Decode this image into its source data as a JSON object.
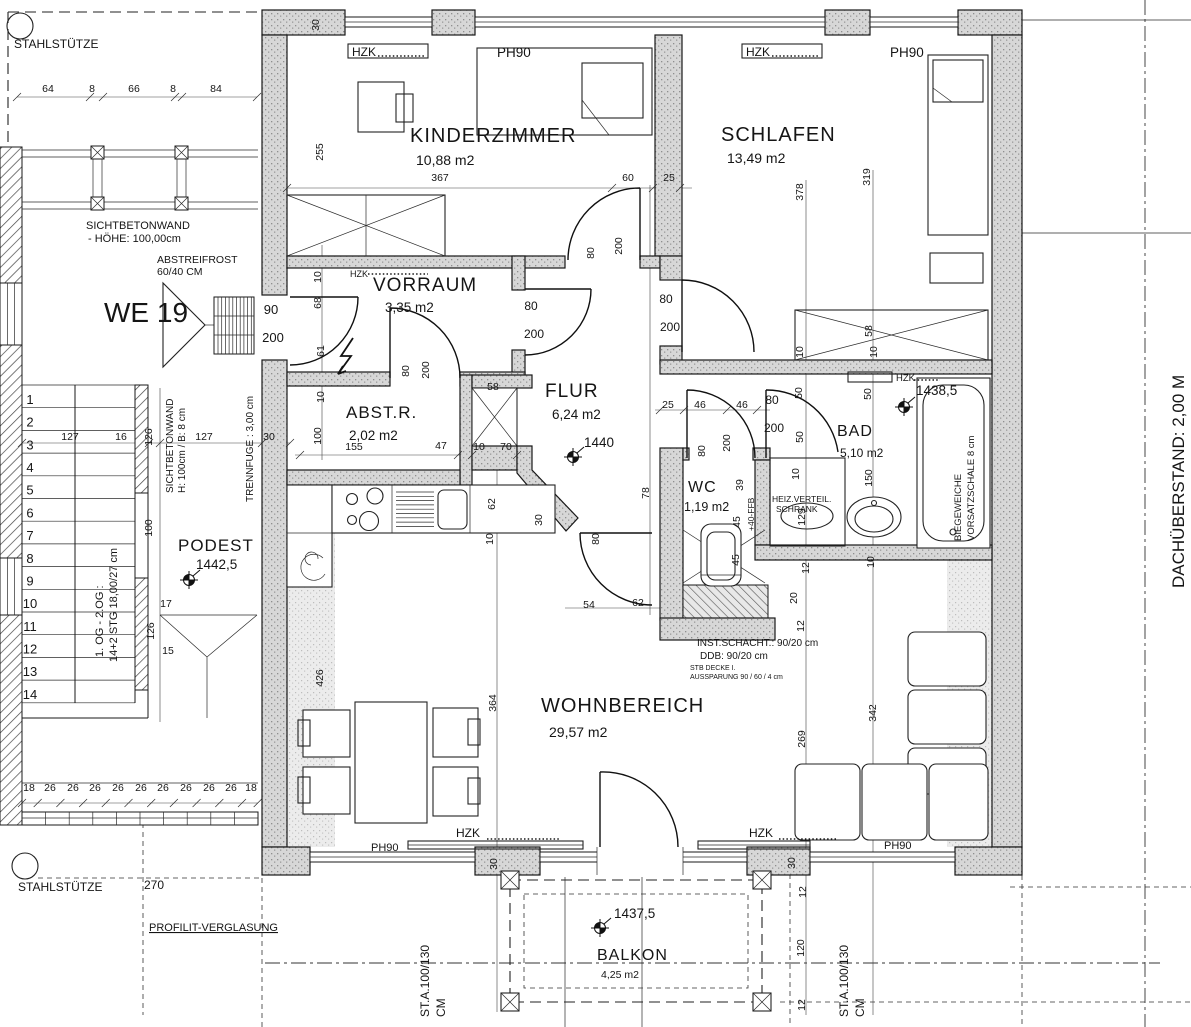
{
  "plan_title": "WE 19",
  "rooms": [
    {
      "name": "KINDERZIMMER",
      "area": "10,88 m2",
      "x": 410,
      "y": 142,
      "s": 20,
      "ax": 416,
      "ay": 165,
      "as": 14
    },
    {
      "name": "SCHLAFEN",
      "area": "13,49 m2",
      "x": 721,
      "y": 141,
      "s": 20,
      "ax": 727,
      "ay": 163,
      "as": 14
    },
    {
      "name": "VORRAUM",
      "area": "3,35 m2",
      "x": 373,
      "y": 291,
      "s": 19,
      "ax": 385,
      "ay": 312,
      "as": 13.5
    },
    {
      "name": "ABST.R.",
      "area": "2,02 m2",
      "x": 346,
      "y": 418,
      "s": 17,
      "ax": 349,
      "ay": 440,
      "as": 13.5
    },
    {
      "name": "FLUR",
      "area": "6,24 m2",
      "x": 545,
      "y": 397,
      "s": 19,
      "ax": 552,
      "ay": 419,
      "as": 13.5
    },
    {
      "name": "WC",
      "area": "1,19 m2",
      "x": 688,
      "y": 492,
      "s": 16,
      "ax": 684,
      "ay": 511,
      "as": 12.5
    },
    {
      "name": "BAD",
      "area": "5,10 m2",
      "x": 837,
      "y": 436,
      "s": 16,
      "ax": 840,
      "ay": 457,
      "as": 12
    },
    {
      "name": "WOHNBEREICH",
      "area": "29,57 m2",
      "x": 541,
      "y": 712,
      "s": 20,
      "ax": 549,
      "ay": 737,
      "as": 14
    },
    {
      "name": "BALKON",
      "area": "4,25 m2",
      "x": 597,
      "y": 960,
      "s": 16,
      "ax": 601,
      "ay": 978,
      "as": 10.5
    },
    {
      "name": "PODEST",
      "area": "",
      "x": 178,
      "y": 551,
      "s": 17,
      "ax": 0,
      "ay": 0,
      "as": 0
    }
  ],
  "levels": [
    {
      "v": "1440",
      "x": 584,
      "y": 447,
      "mx": 573,
      "my": 457
    },
    {
      "v": "1442,5",
      "x": 196,
      "y": 569,
      "mx": 189,
      "my": 580
    },
    {
      "v": "1438,5",
      "x": 916,
      "y": 395,
      "mx": 904,
      "my": 407
    },
    {
      "v": "1437,5",
      "x": 614,
      "y": 918,
      "mx": 600,
      "my": 928
    }
  ],
  "stairs": {
    "numbers": [
      "1",
      "2",
      "3",
      "4",
      "5",
      "6",
      "7",
      "8",
      "9",
      "10",
      "11",
      "12",
      "13",
      "14"
    ]
  },
  "annotations": [
    {
      "t": "STAHLSTÜTZE",
      "x": 14,
      "y": 48,
      "s": 12
    },
    {
      "t": "SICHTBETONWAND",
      "x": 86,
      "y": 229,
      "s": 11
    },
    {
      "t": "- HÖHE: 100,00cm",
      "x": 88,
      "y": 242,
      "s": 11
    },
    {
      "t": "ABSTREIFROST",
      "x": 157,
      "y": 263,
      "s": 10.5
    },
    {
      "t": "60/40 CM",
      "x": 157,
      "y": 275,
      "s": 10.5
    },
    {
      "t": "WE 19",
      "x": 104,
      "y": 322,
      "s": 28
    },
    {
      "t": "HZK",
      "x": 352,
      "y": 56,
      "s": 12
    },
    {
      "t": "PH90",
      "x": 497,
      "y": 57,
      "s": 13.5
    },
    {
      "t": "HZK",
      "x": 746,
      "y": 56,
      "s": 12
    },
    {
      "t": "PH90",
      "x": 890,
      "y": 57,
      "s": 13.5
    },
    {
      "t": "HZK",
      "x": 350,
      "y": 277,
      "s": 9
    },
    {
      "t": "HZK",
      "x": 896,
      "y": 381,
      "s": 9.5
    },
    {
      "t": "HEIZ.VERTEIL.",
      "x": 772,
      "y": 502,
      "s": 8.5
    },
    {
      "t": "SCHRANK",
      "x": 776,
      "y": 512,
      "s": 8.5
    },
    {
      "t": "INST.SCHACHT.: 90/20 cm",
      "x": 697,
      "y": 646,
      "s": 10
    },
    {
      "t": "DDB: 90/20 cm",
      "x": 700,
      "y": 659,
      "s": 10
    },
    {
      "t": "STB DECKE I.",
      "x": 690,
      "y": 670,
      "s": 7
    },
    {
      "t": "AUSSPARUNG 90 / 60 / 4 cm",
      "x": 690,
      "y": 679,
      "s": 7
    },
    {
      "t": "HZK",
      "x": 456,
      "y": 837,
      "s": 12
    },
    {
      "t": "HZK",
      "x": 749,
      "y": 837,
      "s": 12
    },
    {
      "t": "PH90",
      "x": 371,
      "y": 851,
      "s": 11
    },
    {
      "t": "PH90",
      "x": 884,
      "y": 849,
      "s": 11
    },
    {
      "t": "STAHLSTÜTZE",
      "x": 18,
      "y": 891,
      "s": 12
    },
    {
      "t": "PROFILIT-VERGLASUNG",
      "x": 149,
      "y": 931,
      "s": 11,
      "u": 1
    },
    {
      "t": "270",
      "x": 144,
      "y": 889,
      "s": 12
    },
    {
      "t": "DACHÜBERSTAND: 2,00 M",
      "x": 1184,
      "y": 588,
      "s": 17,
      "r": 1
    },
    {
      "t": "ST.A.100/130",
      "x": 429,
      "y": 1017,
      "s": 12,
      "r": 1
    },
    {
      "t": "CM",
      "x": 445,
      "y": 1017,
      "s": 12,
      "r": 1
    },
    {
      "t": "ST.A.100/130",
      "x": 848,
      "y": 1017,
      "s": 12,
      "r": 1
    },
    {
      "t": "CM",
      "x": 864,
      "y": 1017,
      "s": 12,
      "r": 1
    },
    {
      "t": "TRENNFUGE : 3,00 cm",
      "x": 253,
      "y": 502,
      "s": 10,
      "r": 1
    },
    {
      "t": "SICHTBETONWAND",
      "x": 173,
      "y": 493,
      "s": 10,
      "r": 1
    },
    {
      "t": "H: 100cm / B: 8 cm",
      "x": 185,
      "y": 493,
      "s": 10,
      "r": 1
    },
    {
      "t": "1. OG - 2.OG :",
      "x": 103,
      "y": 657,
      "s": 11,
      "r": 1
    },
    {
      "t": "14+2 STG 18,00/27 cm",
      "x": 117,
      "y": 662,
      "s": 11,
      "r": 1
    },
    {
      "t": "BIEGEWEICHE",
      "x": 961,
      "y": 541,
      "s": 9.5,
      "r": 1
    },
    {
      "t": "VORSATZSCHALE 8 cm",
      "x": 974,
      "y": 541,
      "s": 9.5,
      "r": 1
    },
    {
      "t": "+40-FFB",
      "x": 754,
      "y": 531,
      "s": 8.5,
      "r": 1
    }
  ],
  "dimensions": [
    {
      "t": "64",
      "x": 48,
      "y": 92
    },
    {
      "t": "8",
      "x": 92,
      "y": 92
    },
    {
      "t": "66",
      "x": 134,
      "y": 92
    },
    {
      "t": "8",
      "x": 173,
      "y": 92
    },
    {
      "t": "84",
      "x": 216,
      "y": 92
    },
    {
      "t": "30",
      "x": 319,
      "y": 25,
      "r": 1
    },
    {
      "t": "255",
      "x": 323,
      "y": 152,
      "r": 1
    },
    {
      "t": "367",
      "x": 440,
      "y": 181
    },
    {
      "t": "60",
      "x": 628,
      "y": 181
    },
    {
      "t": "25",
      "x": 669,
      "y": 181
    },
    {
      "t": "80",
      "x": 594,
      "y": 253,
      "r": 1
    },
    {
      "t": "200",
      "x": 622,
      "y": 246,
      "r": 1
    },
    {
      "t": "378",
      "x": 803,
      "y": 192,
      "r": 1
    },
    {
      "t": "319",
      "x": 870,
      "y": 177,
      "r": 1
    },
    {
      "t": "90",
      "x": 271,
      "y": 314,
      "s": 13
    },
    {
      "t": "200",
      "x": 273,
      "y": 342,
      "s": 13
    },
    {
      "t": "10",
      "x": 321,
      "y": 277,
      "r": 1
    },
    {
      "t": "68",
      "x": 321,
      "y": 303,
      "r": 1
    },
    {
      "t": "61",
      "x": 324,
      "y": 351,
      "r": 1
    },
    {
      "t": "10",
      "x": 324,
      "y": 397,
      "r": 1
    },
    {
      "t": "80",
      "x": 531,
      "y": 310,
      "s": 12
    },
    {
      "t": "200",
      "x": 534,
      "y": 338,
      "s": 12
    },
    {
      "t": "80",
      "x": 666,
      "y": 303,
      "s": 12
    },
    {
      "t": "200",
      "x": 670,
      "y": 331,
      "s": 12
    },
    {
      "t": "80",
      "x": 409,
      "y": 371,
      "r": 1
    },
    {
      "t": "200",
      "x": 429,
      "y": 370,
      "r": 1
    },
    {
      "t": "155",
      "x": 354,
      "y": 450
    },
    {
      "t": "47",
      "x": 441,
      "y": 449
    },
    {
      "t": "58",
      "x": 493,
      "y": 390
    },
    {
      "t": "10",
      "x": 479,
      "y": 450
    },
    {
      "t": "70",
      "x": 506,
      "y": 450
    },
    {
      "t": "100",
      "x": 321,
      "y": 436,
      "r": 1
    },
    {
      "t": "62",
      "x": 495,
      "y": 504,
      "r": 1
    },
    {
      "t": "10",
      "x": 493,
      "y": 539,
      "r": 1
    },
    {
      "t": "30",
      "x": 542,
      "y": 520,
      "r": 1
    },
    {
      "t": "80",
      "x": 599,
      "y": 539,
      "r": 1
    },
    {
      "t": "54",
      "x": 589,
      "y": 608
    },
    {
      "t": "62",
      "x": 638,
      "y": 606
    },
    {
      "t": "25",
      "x": 668,
      "y": 408
    },
    {
      "t": "46",
      "x": 700,
      "y": 408
    },
    {
      "t": "46",
      "x": 742,
      "y": 408
    },
    {
      "t": "80",
      "x": 772,
      "y": 404,
      "s": 12
    },
    {
      "t": "200",
      "x": 774,
      "y": 432,
      "s": 12
    },
    {
      "t": "80",
      "x": 705,
      "y": 451,
      "r": 1
    },
    {
      "t": "200",
      "x": 730,
      "y": 443,
      "r": 1
    },
    {
      "t": "78",
      "x": 649,
      "y": 493,
      "r": 1
    },
    {
      "t": "39",
      "x": 743,
      "y": 485,
      "r": 1
    },
    {
      "t": "45",
      "x": 740,
      "y": 522,
      "r": 1
    },
    {
      "t": "45",
      "x": 739,
      "y": 560,
      "r": 1
    },
    {
      "t": "10",
      "x": 799,
      "y": 474,
      "r": 1
    },
    {
      "t": "129",
      "x": 805,
      "y": 517,
      "r": 1
    },
    {
      "t": "50",
      "x": 802,
      "y": 393,
      "r": 1
    },
    {
      "t": "50",
      "x": 871,
      "y": 394,
      "r": 1
    },
    {
      "t": "50",
      "x": 803,
      "y": 437,
      "r": 1
    },
    {
      "t": "150",
      "x": 872,
      "y": 478,
      "r": 1
    },
    {
      "t": "10",
      "x": 874,
      "y": 562,
      "r": 1
    },
    {
      "t": "12",
      "x": 809,
      "y": 568,
      "r": 1
    },
    {
      "t": "20",
      "x": 797,
      "y": 598,
      "r": 1
    },
    {
      "t": "12",
      "x": 804,
      "y": 626,
      "r": 1
    },
    {
      "t": "58",
      "x": 872,
      "y": 331,
      "r": 1
    },
    {
      "t": "10",
      "x": 803,
      "y": 352,
      "r": 1
    },
    {
      "t": "10",
      "x": 877,
      "y": 352,
      "r": 1
    },
    {
      "t": "426",
      "x": 323,
      "y": 678,
      "r": 1
    },
    {
      "t": "364",
      "x": 496,
      "y": 703,
      "r": 1
    },
    {
      "t": "342",
      "x": 876,
      "y": 713,
      "r": 1
    },
    {
      "t": "269",
      "x": 805,
      "y": 739,
      "r": 1
    },
    {
      "t": "127",
      "x": 70,
      "y": 440
    },
    {
      "t": "16",
      "x": 121,
      "y": 440
    },
    {
      "t": "127",
      "x": 204,
      "y": 440
    },
    {
      "t": "30",
      "x": 269,
      "y": 440
    },
    {
      "t": "126",
      "x": 152,
      "y": 437,
      "r": 1
    },
    {
      "t": "100",
      "x": 152,
      "y": 528,
      "r": 1
    },
    {
      "t": "17",
      "x": 166,
      "y": 607
    },
    {
      "t": "126",
      "x": 154,
      "y": 631,
      "r": 1
    },
    {
      "t": "15",
      "x": 168,
      "y": 654
    },
    {
      "t": "18",
      "x": 29,
      "y": 791
    },
    {
      "t": "26",
      "x": 50,
      "y": 791
    },
    {
      "t": "26",
      "x": 73,
      "y": 791
    },
    {
      "t": "26",
      "x": 95,
      "y": 791
    },
    {
      "t": "26",
      "x": 118,
      "y": 791
    },
    {
      "t": "26",
      "x": 141,
      "y": 791
    },
    {
      "t": "26",
      "x": 163,
      "y": 791
    },
    {
      "t": "26",
      "x": 186,
      "y": 791
    },
    {
      "t": "26",
      "x": 209,
      "y": 791
    },
    {
      "t": "26",
      "x": 231,
      "y": 791
    },
    {
      "t": "18",
      "x": 251,
      "y": 791
    },
    {
      "t": "30",
      "x": 497,
      "y": 864,
      "r": 1
    },
    {
      "t": "30",
      "x": 795,
      "y": 863,
      "r": 1
    },
    {
      "t": "12",
      "x": 806,
      "y": 892,
      "r": 1
    },
    {
      "t": "120",
      "x": 804,
      "y": 948,
      "r": 1
    },
    {
      "t": "12",
      "x": 805,
      "y": 1005,
      "r": 1
    }
  ]
}
